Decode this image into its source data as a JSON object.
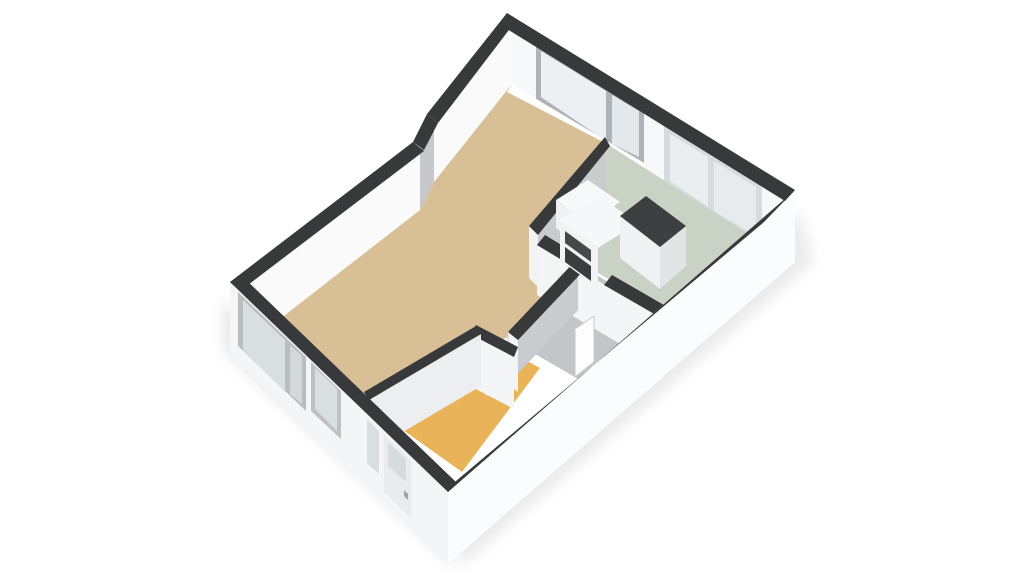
{
  "meta": {
    "title": "3d-floorplan-render",
    "view": "isometric-3d",
    "background": "#FFFFFF",
    "wall_top_color": "#38393B",
    "canvas": {
      "width": 1024,
      "height": 576
    }
  },
  "rooms": [
    {
      "name": "living-room",
      "floor_color": "#D8BF96"
    },
    {
      "name": "kitchen",
      "floor_color": "#C9D2C5"
    },
    {
      "name": "bathroom",
      "floor_color": "#C2C6C8"
    },
    {
      "name": "entrance-hall",
      "floor_color": "#E9B459"
    }
  ],
  "shapes": [
    {
      "name": "ground-shadow-sw",
      "fill": "#BFBFBF",
      "opacity": 0.35,
      "blur": true,
      "pts": [
        [
          222,
          300
        ],
        [
          450,
          512
        ],
        [
          452,
          566
        ],
        [
          224,
          352
        ]
      ]
    },
    {
      "name": "ground-shadow-se",
      "fill": "#BFBFBF",
      "opacity": 0.3,
      "blur": true,
      "pts": [
        [
          446,
          514
        ],
        [
          800,
          212
        ],
        [
          814,
          262
        ],
        [
          462,
          566
        ]
      ]
    },
    {
      "name": "nw-wall-interior-face",
      "fill": "#FAFAFB",
      "pts": [
        [
          512,
          22
        ],
        [
          434,
          120
        ],
        [
          420,
          148
        ],
        [
          240,
          288
        ],
        [
          240,
          350
        ],
        [
          420,
          210
        ],
        [
          434,
          182
        ],
        [
          512,
          84
        ]
      ]
    },
    {
      "name": "nw-wall-step-face",
      "fill": "#C6C8CC",
      "pts": [
        [
          434,
          120
        ],
        [
          420,
          148
        ],
        [
          420,
          210
        ],
        [
          434,
          182
        ]
      ]
    },
    {
      "name": "ne-wall-interior-face",
      "fill": "#F7F8F9",
      "pts": [
        [
          512,
          22
        ],
        [
          786,
          196
        ],
        [
          786,
          258
        ],
        [
          512,
          84
        ]
      ]
    },
    {
      "name": "living-window-frame",
      "fill": "#AEB3B7",
      "pts": [
        [
          536,
          44
        ],
        [
          644,
          110
        ],
        [
          644,
          163
        ],
        [
          536,
          99
        ]
      ]
    },
    {
      "name": "living-window-glass-left",
      "fill": "#EDF0F2",
      "pts": [
        [
          541,
          51
        ],
        [
          606,
          91
        ],
        [
          606,
          141
        ],
        [
          541,
          97
        ]
      ]
    },
    {
      "name": "living-window-glass-right",
      "fill": "#E4E8EA",
      "pts": [
        [
          612,
          95
        ],
        [
          639,
          111
        ],
        [
          639,
          157
        ],
        [
          612,
          144
        ]
      ]
    },
    {
      "name": "living-window-sill",
      "fill": "#FFFFFF",
      "pts": [
        [
          536,
          99
        ],
        [
          644,
          163
        ],
        [
          644,
          169
        ],
        [
          536,
          105
        ]
      ]
    },
    {
      "name": "kitchen-window-frame",
      "fill": "#D8DBDD",
      "pts": [
        [
          664,
          126
        ],
        [
          762,
          186
        ],
        [
          762,
          242
        ],
        [
          664,
          186
        ]
      ]
    },
    {
      "name": "kitchen-window-glass-left",
      "fill": "#EBEEF0",
      "pts": [
        [
          670,
          134
        ],
        [
          708,
          157
        ],
        [
          708,
          207
        ],
        [
          670,
          181
        ]
      ]
    },
    {
      "name": "kitchen-window-glass-right",
      "fill": "#E7EBED",
      "pts": [
        [
          714,
          161
        ],
        [
          756,
          187
        ],
        [
          756,
          236
        ],
        [
          714,
          211
        ]
      ]
    },
    {
      "name": "kitchen-floor",
      "fill": "#C9D2C5",
      "pts": [
        [
          607,
          144
        ],
        [
          786,
          258
        ],
        [
          672,
          317
        ],
        [
          543,
          240
        ],
        [
          531,
          228
        ]
      ]
    },
    {
      "name": "bathroom-floor",
      "fill": "#C2C6C8",
      "pts": [
        [
          543,
          244
        ],
        [
          674,
          320
        ],
        [
          604,
          394
        ],
        [
          473,
          318
        ]
      ]
    },
    {
      "name": "hallway-floor",
      "fill": "#E9B459",
      "pts": [
        [
          470,
          330
        ],
        [
          540,
          368
        ],
        [
          462,
          472
        ],
        [
          358,
          398
        ]
      ]
    },
    {
      "name": "living-room-floor",
      "fill": "#D8BF96",
      "pts": [
        [
          507,
          92
        ],
        [
          607,
          144
        ],
        [
          531,
          228
        ],
        [
          553,
          251
        ],
        [
          583,
          263
        ],
        [
          513,
          335
        ],
        [
          515,
          352
        ],
        [
          480,
          332
        ],
        [
          366,
          396
        ],
        [
          243,
          280
        ],
        [
          240,
          350
        ],
        [
          420,
          210
        ],
        [
          434,
          182
        ],
        [
          512,
          84
        ]
      ]
    },
    {
      "name": "wall-living-kitchen-face",
      "fill": "#C9CBCE",
      "pts": [
        [
          605,
          137
        ],
        [
          529,
          226
        ],
        [
          529,
          278
        ],
        [
          605,
          189
        ]
      ]
    },
    {
      "name": "wall-living-kitchen-endcap",
      "fill": "#F2F3F4",
      "pts": [
        [
          529,
          226
        ],
        [
          538,
          235
        ],
        [
          538,
          287
        ],
        [
          529,
          278
        ]
      ]
    },
    {
      "name": "wall-living-kitchen-top",
      "fill": "#38393B",
      "pts": [
        [
          605,
          137
        ],
        [
          610,
          146
        ],
        [
          538,
          235
        ],
        [
          529,
          226
        ]
      ]
    },
    {
      "name": "wall-kitchen-bathroom-face",
      "fill": "#F4F5F6",
      "pts": [
        [
          537,
          245
        ],
        [
          668,
          322
        ],
        [
          668,
          372
        ],
        [
          537,
          295
        ]
      ]
    },
    {
      "name": "wall-kitchen-bathroom-top-west",
      "fill": "#38393B",
      "pts": [
        [
          545,
          235
        ],
        [
          588,
          261
        ],
        [
          580,
          271
        ],
        [
          537,
          245
        ]
      ]
    },
    {
      "name": "wall-kitchen-bathroom-top-east",
      "fill": "#38393B",
      "pts": [
        [
          612,
          275
        ],
        [
          676,
          312
        ],
        [
          668,
          322
        ],
        [
          604,
          285
        ]
      ]
    },
    {
      "name": "kitchen-door-leaf",
      "fill": "#FDFDFE",
      "stroke": "#C6C9CB",
      "pts": [
        [
          594,
          316
        ],
        [
          575,
          329
        ],
        [
          575,
          377
        ],
        [
          594,
          362
        ]
      ]
    },
    {
      "name": "wall-bathroom-west-face",
      "fill": "#C9CBCE",
      "pts": [
        [
          578,
          258
        ],
        [
          508,
          332
        ],
        [
          508,
          384
        ],
        [
          578,
          310
        ]
      ]
    },
    {
      "name": "wall-bathroom-west-endcap",
      "fill": "#F2F3F4",
      "pts": [
        [
          508,
          332
        ],
        [
          518,
          340
        ],
        [
          518,
          392
        ],
        [
          508,
          384
        ]
      ]
    },
    {
      "name": "wall-bathroom-west-top",
      "fill": "#38393B",
      "pts": [
        [
          578,
          258
        ],
        [
          588,
          266
        ],
        [
          518,
          340
        ],
        [
          508,
          332
        ]
      ]
    },
    {
      "name": "bathroom-door-leaf",
      "fill": "#FDFDFE",
      "stroke": "#C6C9CB",
      "pts": [
        [
          508,
          336
        ],
        [
          486,
          350
        ],
        [
          486,
          396
        ],
        [
          508,
          382
        ]
      ]
    },
    {
      "name": "wall-hall-living-face",
      "fill": "#F4F5F6",
      "pts": [
        [
          472,
          335
        ],
        [
          514,
          357
        ],
        [
          514,
          409
        ],
        [
          472,
          387
        ]
      ]
    },
    {
      "name": "wall-hall-living-top",
      "fill": "#38393B",
      "pts": [
        [
          476,
          325
        ],
        [
          518,
          347
        ],
        [
          514,
          357
        ],
        [
          472,
          335
        ]
      ]
    },
    {
      "name": "hallway-door-leaf",
      "fill": "#FDFDFE",
      "stroke": "#C6C9CB",
      "pts": [
        [
          476,
          329
        ],
        [
          452,
          343
        ],
        [
          452,
          389
        ],
        [
          476,
          375
        ]
      ]
    },
    {
      "name": "wall-hall-west-face",
      "fill": "#EDEEF0",
      "pts": [
        [
          369,
          400
        ],
        [
          481,
          334
        ],
        [
          481,
          386
        ],
        [
          369,
          452
        ]
      ]
    },
    {
      "name": "wall-hall-west-top",
      "fill": "#38393B",
      "pts": [
        [
          364,
          392
        ],
        [
          476,
          326
        ],
        [
          481,
          334
        ],
        [
          369,
          400
        ]
      ]
    },
    {
      "name": "kitchen-cabinet-back-top",
      "fill": "#F7F8F9",
      "pts": [
        [
          556,
          200
        ],
        [
          588,
          180
        ],
        [
          620,
          202
        ],
        [
          588,
          224
        ]
      ]
    },
    {
      "name": "kitchen-cabinet-back-face",
      "fill": "#EFF1F3",
      "pts": [
        [
          556,
          200
        ],
        [
          588,
          224
        ],
        [
          588,
          252
        ],
        [
          556,
          228
        ]
      ]
    },
    {
      "name": "kitchen-counter-front-face",
      "fill": "#F2F3F5",
      "pts": [
        [
          560,
          220
        ],
        [
          598,
          248
        ],
        [
          598,
          288
        ],
        [
          560,
          260
        ]
      ]
    },
    {
      "name": "kitchen-counter-top",
      "fill": "#F6F7F8",
      "pts": [
        [
          560,
          220
        ],
        [
          600,
          197
        ],
        [
          638,
          223
        ],
        [
          598,
          248
        ]
      ]
    },
    {
      "name": "kitchen-appliance-upper",
      "fill": "#47484A",
      "pts": [
        [
          565,
          231
        ],
        [
          591,
          250
        ],
        [
          591,
          262
        ],
        [
          565,
          243
        ]
      ]
    },
    {
      "name": "kitchen-appliance-lower",
      "fill": "#3C3D3F",
      "pts": [
        [
          565,
          247
        ],
        [
          591,
          266
        ],
        [
          591,
          281
        ],
        [
          565,
          262
        ]
      ]
    },
    {
      "name": "kitchen-island-front-face",
      "fill": "#F0F1F3",
      "pts": [
        [
          620,
          216
        ],
        [
          660,
          247
        ],
        [
          660,
          289
        ],
        [
          620,
          258
        ]
      ]
    },
    {
      "name": "kitchen-island-side-face",
      "fill": "#E2E4E7",
      "pts": [
        [
          660,
          247
        ],
        [
          686,
          226
        ],
        [
          686,
          266
        ],
        [
          660,
          289
        ]
      ]
    },
    {
      "name": "kitchen-island-top",
      "fill": "#3E3F41",
      "pts": [
        [
          620,
          216
        ],
        [
          646,
          196
        ],
        [
          686,
          226
        ],
        [
          660,
          247
        ]
      ]
    },
    {
      "name": "sw-exterior-wall-face",
      "fill": "#F4F5F7",
      "pts": [
        [
          230,
          282
        ],
        [
          448,
          492
        ],
        [
          448,
          564
        ],
        [
          230,
          354
        ]
      ]
    },
    {
      "name": "sw-window-large-frame",
      "fill": "#B9BDC0",
      "pts": [
        [
          238,
          292
        ],
        [
          306,
          357
        ],
        [
          306,
          411
        ],
        [
          238,
          346
        ]
      ]
    },
    {
      "name": "sw-window-large-glass",
      "fill": "#D9DEE1",
      "pts": [
        [
          243,
          300
        ],
        [
          285,
          340
        ],
        [
          285,
          392
        ],
        [
          243,
          350
        ]
      ]
    },
    {
      "name": "sw-window-large-glass2",
      "fill": "#D2D7DA",
      "pts": [
        [
          290,
          345
        ],
        [
          302,
          356
        ],
        [
          302,
          404
        ],
        [
          290,
          394
        ]
      ]
    },
    {
      "name": "sw-window-small-frame",
      "fill": "#BDC1C4",
      "pts": [
        [
          311,
          362
        ],
        [
          341,
          391
        ],
        [
          341,
          439
        ],
        [
          311,
          411
        ]
      ]
    },
    {
      "name": "sw-window-small-glass",
      "fill": "#D9DEE1",
      "pts": [
        [
          315,
          368
        ],
        [
          337,
          389
        ],
        [
          337,
          431
        ],
        [
          315,
          409
        ]
      ]
    },
    {
      "name": "entry-sidelight-glass",
      "fill": "#D9DEE1",
      "pts": [
        [
          367,
          419
        ],
        [
          379,
          431
        ],
        [
          379,
          474
        ],
        [
          367,
          463
        ]
      ]
    },
    {
      "name": "entry-door",
      "fill": "#E9EBED",
      "pts": [
        [
          384,
          434
        ],
        [
          411,
          460
        ],
        [
          411,
          518
        ],
        [
          384,
          492
        ]
      ]
    },
    {
      "name": "entry-door-glass",
      "fill": "#D6DBDE",
      "pts": [
        [
          388,
          442
        ],
        [
          406,
          459
        ],
        [
          406,
          482
        ],
        [
          388,
          466
        ]
      ]
    },
    {
      "name": "entry-door-handle",
      "fill": "#9EA3A7",
      "pts": [
        [
          404,
          490
        ],
        [
          408,
          494
        ],
        [
          408,
          500
        ],
        [
          404,
          496
        ]
      ]
    },
    {
      "name": "se-exterior-wall-face",
      "fill": "#FBFCFD",
      "pts": [
        [
          795,
          190
        ],
        [
          448,
          492
        ],
        [
          448,
          564
        ],
        [
          795,
          262
        ]
      ]
    },
    {
      "name": "ne-wall-top",
      "fill": "#38393B",
      "pts": [
        [
          507,
          13
        ],
        [
          795,
          190
        ],
        [
          785,
          201
        ],
        [
          499,
          24
        ]
      ]
    },
    {
      "name": "nw-wall-top-upper",
      "fill": "#38393B",
      "pts": [
        [
          507,
          13
        ],
        [
          427,
          114
        ],
        [
          438,
          123
        ],
        [
          515,
          22
        ]
      ]
    },
    {
      "name": "nw-wall-top-step",
      "fill": "#38393B",
      "pts": [
        [
          427,
          114
        ],
        [
          413,
          142
        ],
        [
          424,
          150
        ],
        [
          438,
          123
        ]
      ]
    },
    {
      "name": "nw-wall-top-lower",
      "fill": "#38393B",
      "pts": [
        [
          413,
          142
        ],
        [
          230,
          282
        ],
        [
          240,
          291
        ],
        [
          424,
          151
        ]
      ]
    },
    {
      "name": "sw-wall-top",
      "fill": "#38393B",
      "pts": [
        [
          230,
          282
        ],
        [
          448,
          492
        ],
        [
          457,
          483
        ],
        [
          241,
          275
        ]
      ]
    },
    {
      "name": "se-wall-top",
      "fill": "#38393B",
      "pts": [
        [
          795,
          190
        ],
        [
          448,
          492
        ],
        [
          456,
          481
        ],
        [
          764,
          222
        ]
      ]
    }
  ]
}
